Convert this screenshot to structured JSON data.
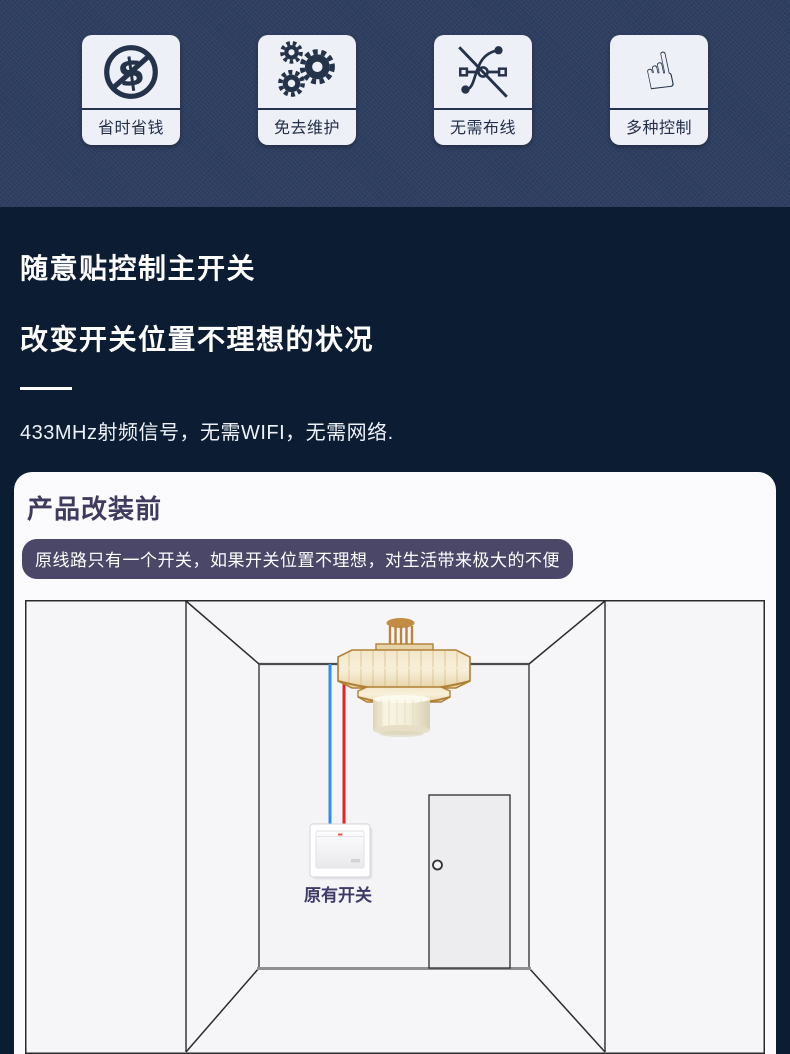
{
  "colors": {
    "page_bg": "#0b1c33",
    "hero_bg": "#2e3e60",
    "badge_bg": "#eef0f7",
    "icon_ink": "#24324a",
    "card_bg": "#fbfbfd",
    "card_title_ink": "#3f3b5e",
    "banner_bg": "#4a4769",
    "banner_ink": "#ffffff",
    "wire_blue": "#2f8fe8",
    "wire_red": "#e62222",
    "switch_label_ink": "#3d3a68"
  },
  "features": [
    {
      "icon": "no-money-icon",
      "label": "省时省钱"
    },
    {
      "icon": "gears-icon",
      "label": "免去维护"
    },
    {
      "icon": "no-wiring-icon",
      "label": "无需布线"
    },
    {
      "icon": "tap-control-icon",
      "label": "多种控制"
    }
  ],
  "intro": {
    "heading_line1": "随意贴控制主开关",
    "heading_line2": "改变开关位置不理想的状况",
    "subtitle": "433MHz射频信号，无需WIFI，无需网络."
  },
  "card": {
    "title": "产品改装前",
    "banner": "原线路只有一个开关，如果开关位置不理想，对生活带来极大的不便",
    "diagram": {
      "switch_label": "原有开关"
    }
  }
}
